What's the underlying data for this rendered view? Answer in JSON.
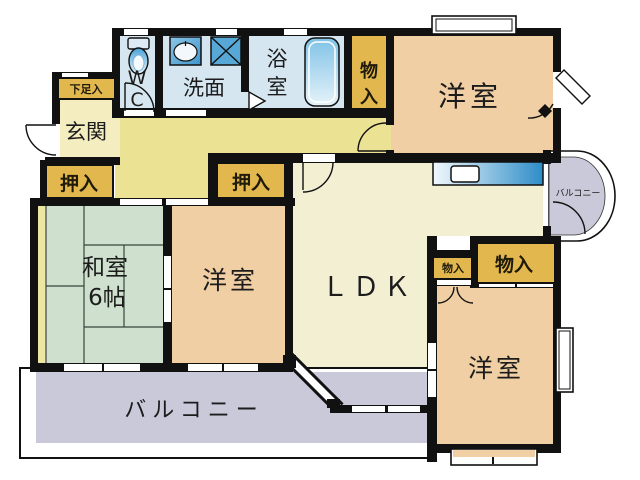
{
  "floorplan": {
    "rooms": {
      "genkan": {
        "label": "玄関"
      },
      "getabako": {
        "label": "下足入"
      },
      "wc": {
        "label": "WC",
        "chars": [
          "W",
          "C"
        ]
      },
      "senmen": {
        "label": "洗面"
      },
      "yokushitsu": {
        "label": "浴室",
        "chars": [
          "浴",
          "室"
        ]
      },
      "monoire_top": {
        "label": "物入",
        "chars": [
          "物",
          "入"
        ]
      },
      "yoshitsu_tr": {
        "label": "洋室"
      },
      "oshiire_left": {
        "label": "押入"
      },
      "oshiire_mid": {
        "label": "押入"
      },
      "washitsu": {
        "label": "和室",
        "size_label": "6帖"
      },
      "yoshitsu_mid": {
        "label": "洋室"
      },
      "ldk": {
        "label": "ＬＤＫ"
      },
      "monoire_small": {
        "label": "物入"
      },
      "monoire_large": {
        "label": "物入"
      },
      "yoshitsu_br": {
        "label": "洋室"
      },
      "balcony_main": {
        "label": "バルコニー"
      },
      "balcony_small": {
        "label": "バルコニー"
      }
    },
    "colors": {
      "wall": "#111111",
      "wet_room_blue": "#d6e6f0",
      "hallway_yellow": "#ece294",
      "entrance_cream": "#f3edc0",
      "ldk_cream": "#f3efd3",
      "storage_gold": "#e2b84e",
      "western_room_peach": "#f1cfa4",
      "tatami_green": "#cfe0cf",
      "balcony_lavender": "#c9c9da",
      "kitchen_counter_blue": "#2d8dc8",
      "fixture_blue": "#57a7d7"
    }
  }
}
